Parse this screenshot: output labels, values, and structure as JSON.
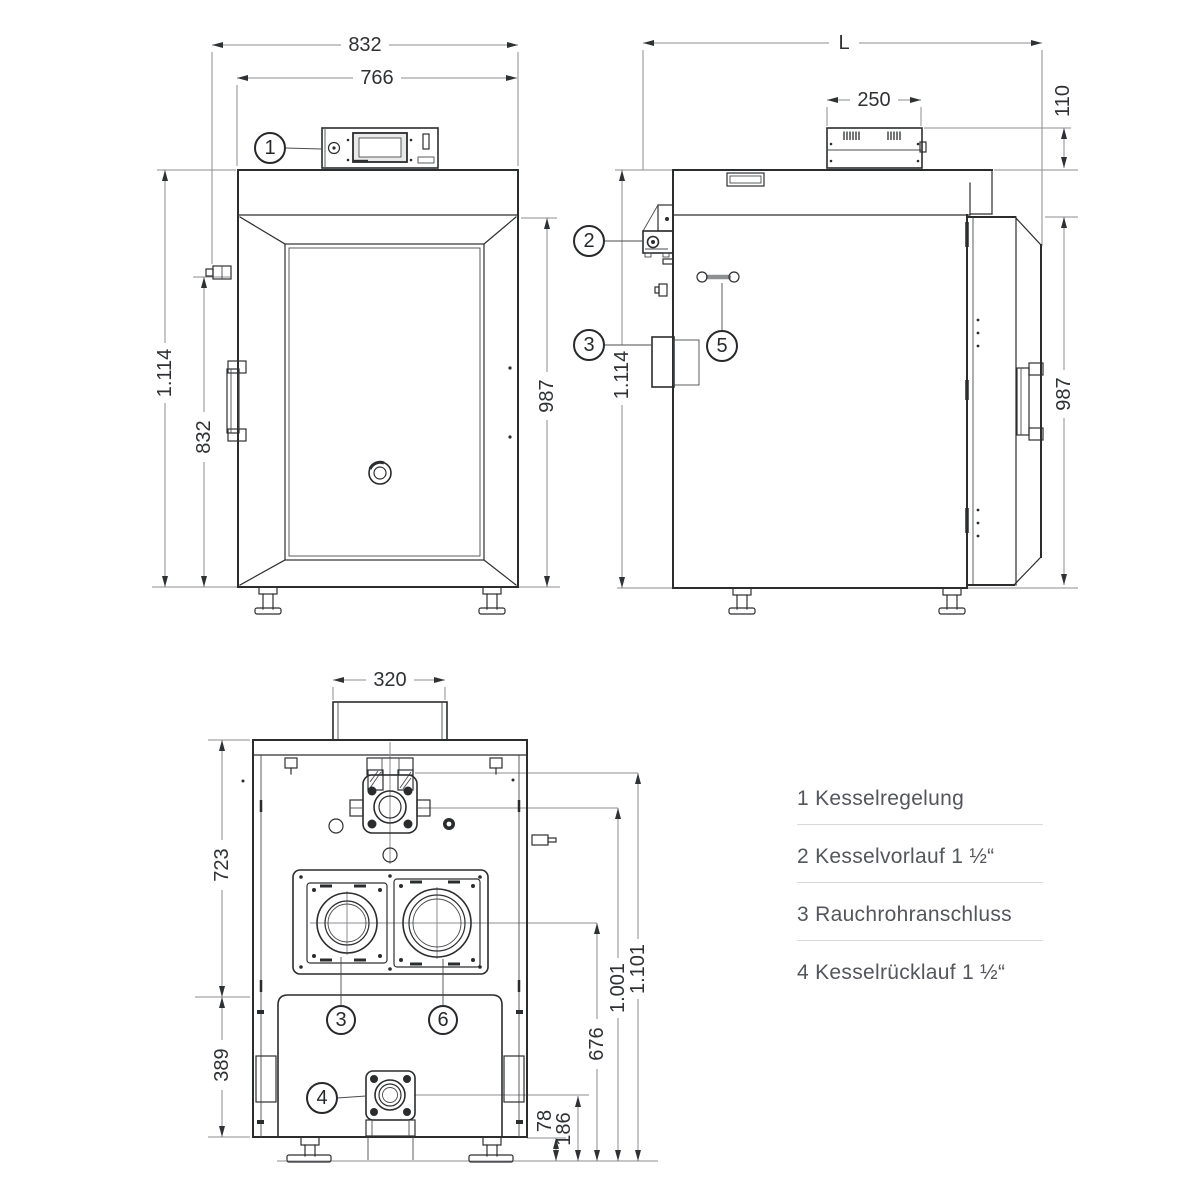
{
  "views": {
    "front": {
      "dims": {
        "width_outer": "832",
        "width_body": "766",
        "height_total": "1.114",
        "height_fitting": "832",
        "height_body": "987"
      },
      "callouts": {
        "controller": "1"
      }
    },
    "side": {
      "dims": {
        "length": "L",
        "panel_depth": "250",
        "panel_height": "110",
        "height_total": "1.114",
        "height_door": "987"
      },
      "callouts": {
        "vorlauf": "2",
        "rauchrohr": "3",
        "griff": "5"
      }
    },
    "rear": {
      "dims": {
        "duct_width": "320",
        "upper_height": "723",
        "lower_height": "389",
        "openings_center": "676",
        "vorlauf_center": "1.001",
        "flange_top": "1.101",
        "ruecklauf_center": "186",
        "base_height": "78"
      },
      "callouts": {
        "opening_left": "3",
        "opening_right": "6",
        "ruecklauf": "4"
      }
    }
  },
  "legend": {
    "items": [
      {
        "num": "1",
        "label": "Kesselregelung"
      },
      {
        "num": "2",
        "label": "Kesselvorlauf 1 ½“"
      },
      {
        "num": "3",
        "label": "Rauchrohranschluss"
      },
      {
        "num": "4",
        "label": "Kesselrücklauf 1 ½“"
      }
    ]
  }
}
